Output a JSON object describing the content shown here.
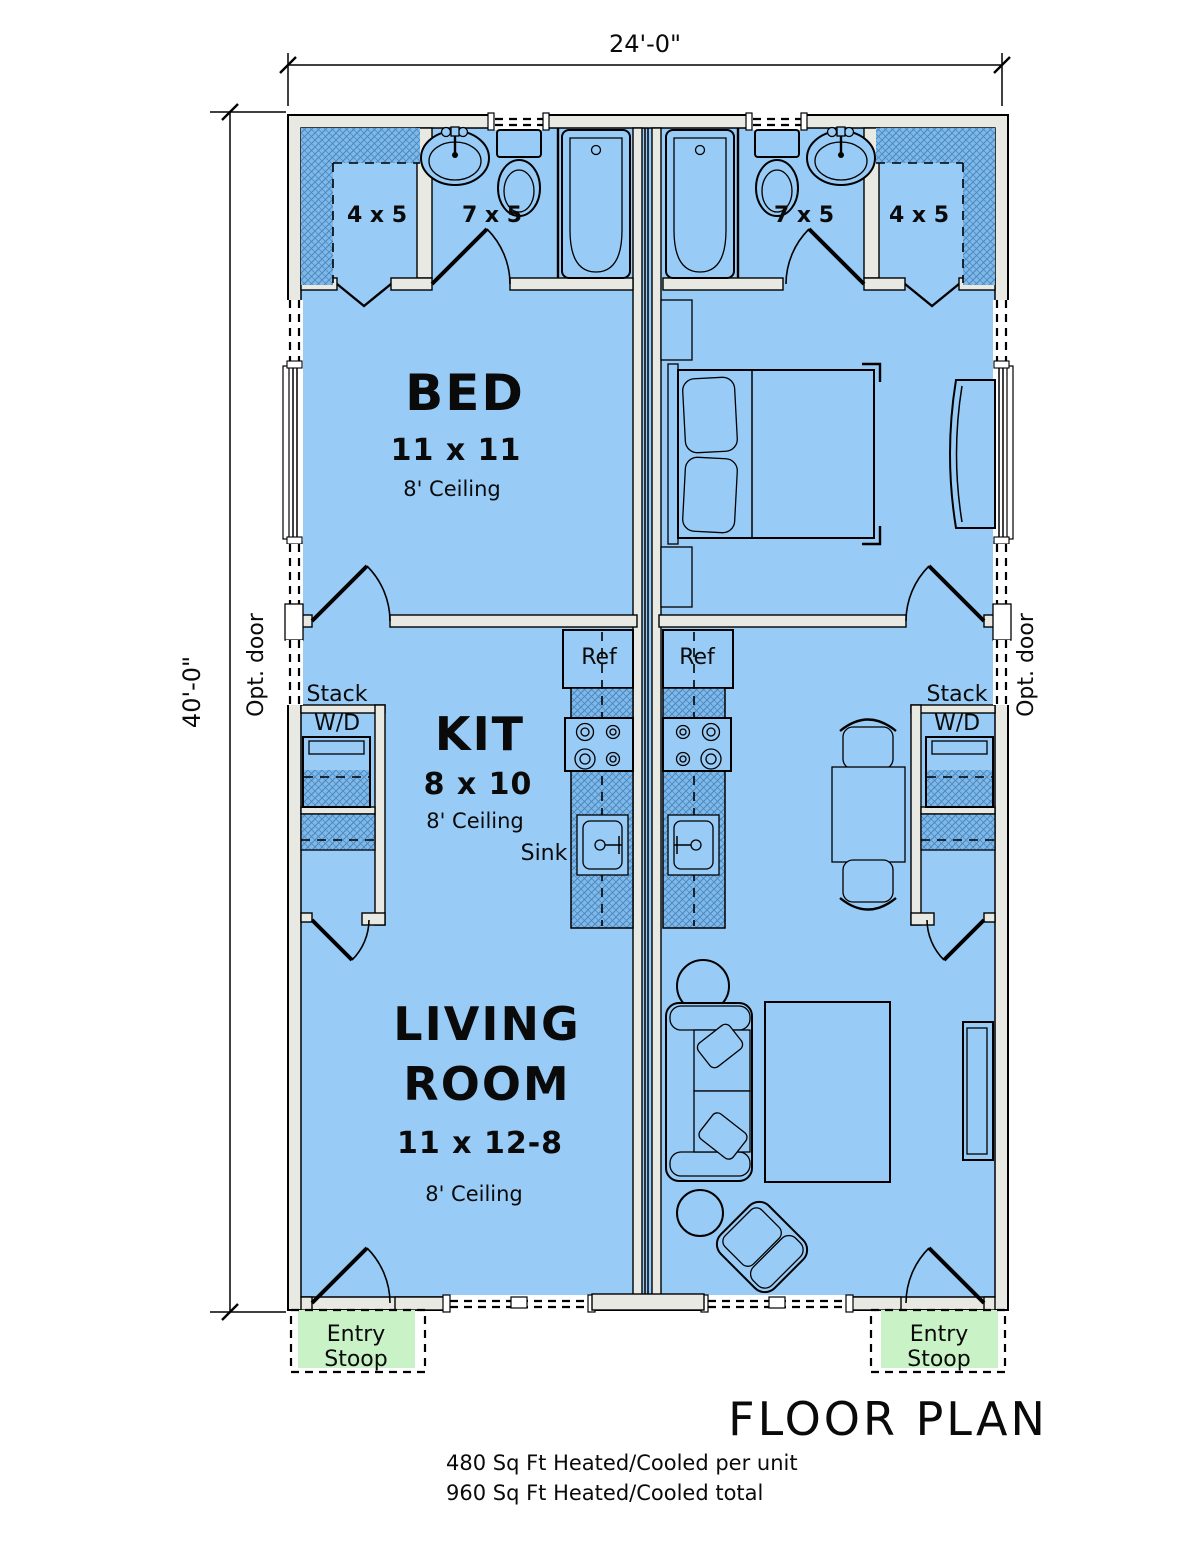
{
  "title": "FLOOR PLAN",
  "notes": {
    "per_unit": "480 Sq Ft Heated/Cooled per unit",
    "total": "960 Sq Ft Heated/Cooled total"
  },
  "dimensions": {
    "width": "24'-0\"",
    "height": "40'-0\""
  },
  "rooms": {
    "bed": {
      "name": "BED",
      "size": "11 x 11",
      "ceiling": "8' Ceiling"
    },
    "kitchen": {
      "name": "KIT",
      "size": "8 x 10",
      "ceiling": "8' Ceiling"
    },
    "living": {
      "name_line1": "LIVING",
      "name_line2": "ROOM",
      "size": "11 x 12-8",
      "ceiling": "8' Ceiling"
    },
    "closet": {
      "size": "4 x 5"
    },
    "bath": {
      "size": "7 x 5"
    }
  },
  "labels": {
    "opt_door": "Opt. door",
    "ref": "Ref",
    "sink": "Sink",
    "stack": "Stack",
    "wd": "W/D",
    "entry": "Entry",
    "stoop": "Stoop"
  },
  "colors": {
    "floor_fill": "#98cbf5",
    "hatch_fill": "#7fb9ea",
    "hatch_line": "#4a86bd",
    "wall_fill": "#e9e9e4",
    "stoop_fill": "#c9f2c6",
    "line": "#000000"
  }
}
